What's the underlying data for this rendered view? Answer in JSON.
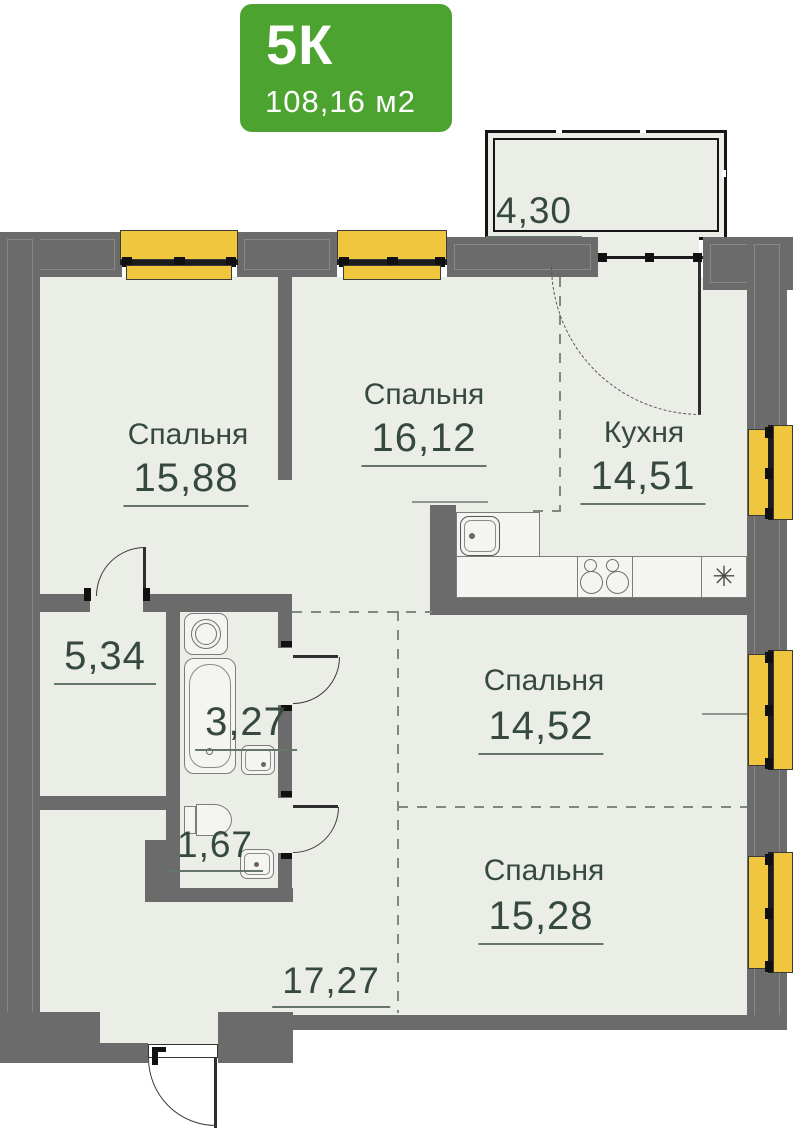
{
  "badge": {
    "rooms_label": "5К",
    "area_label": "108,16 м2"
  },
  "rooms": [
    {
      "key": "bedroom-1",
      "name": "Спальня",
      "area": "15,88"
    },
    {
      "key": "bedroom-2",
      "name": "Спальня",
      "area": "16,12"
    },
    {
      "key": "kitchen",
      "name": "Кухня",
      "area": "14,51"
    },
    {
      "key": "bedroom-3",
      "name": "Спальня",
      "area": "14,52"
    },
    {
      "key": "bedroom-4",
      "name": "Спальня",
      "area": "15,28"
    },
    {
      "key": "balcony",
      "area": "4,30"
    },
    {
      "key": "wardrobe",
      "area": "5,34"
    },
    {
      "key": "bathroom",
      "area": "3,27"
    },
    {
      "key": "wc",
      "area": "1,67"
    },
    {
      "key": "hallway",
      "area": "17,27"
    }
  ],
  "symbols": {
    "appliance_asterisk": "✳"
  },
  "colors": {
    "accent_green": "#4CA32F",
    "window_yellow": "#F0C63E",
    "wall_gray": "#6B6B6B",
    "label_green": "#35493F",
    "floor": "#EBEDE7"
  }
}
